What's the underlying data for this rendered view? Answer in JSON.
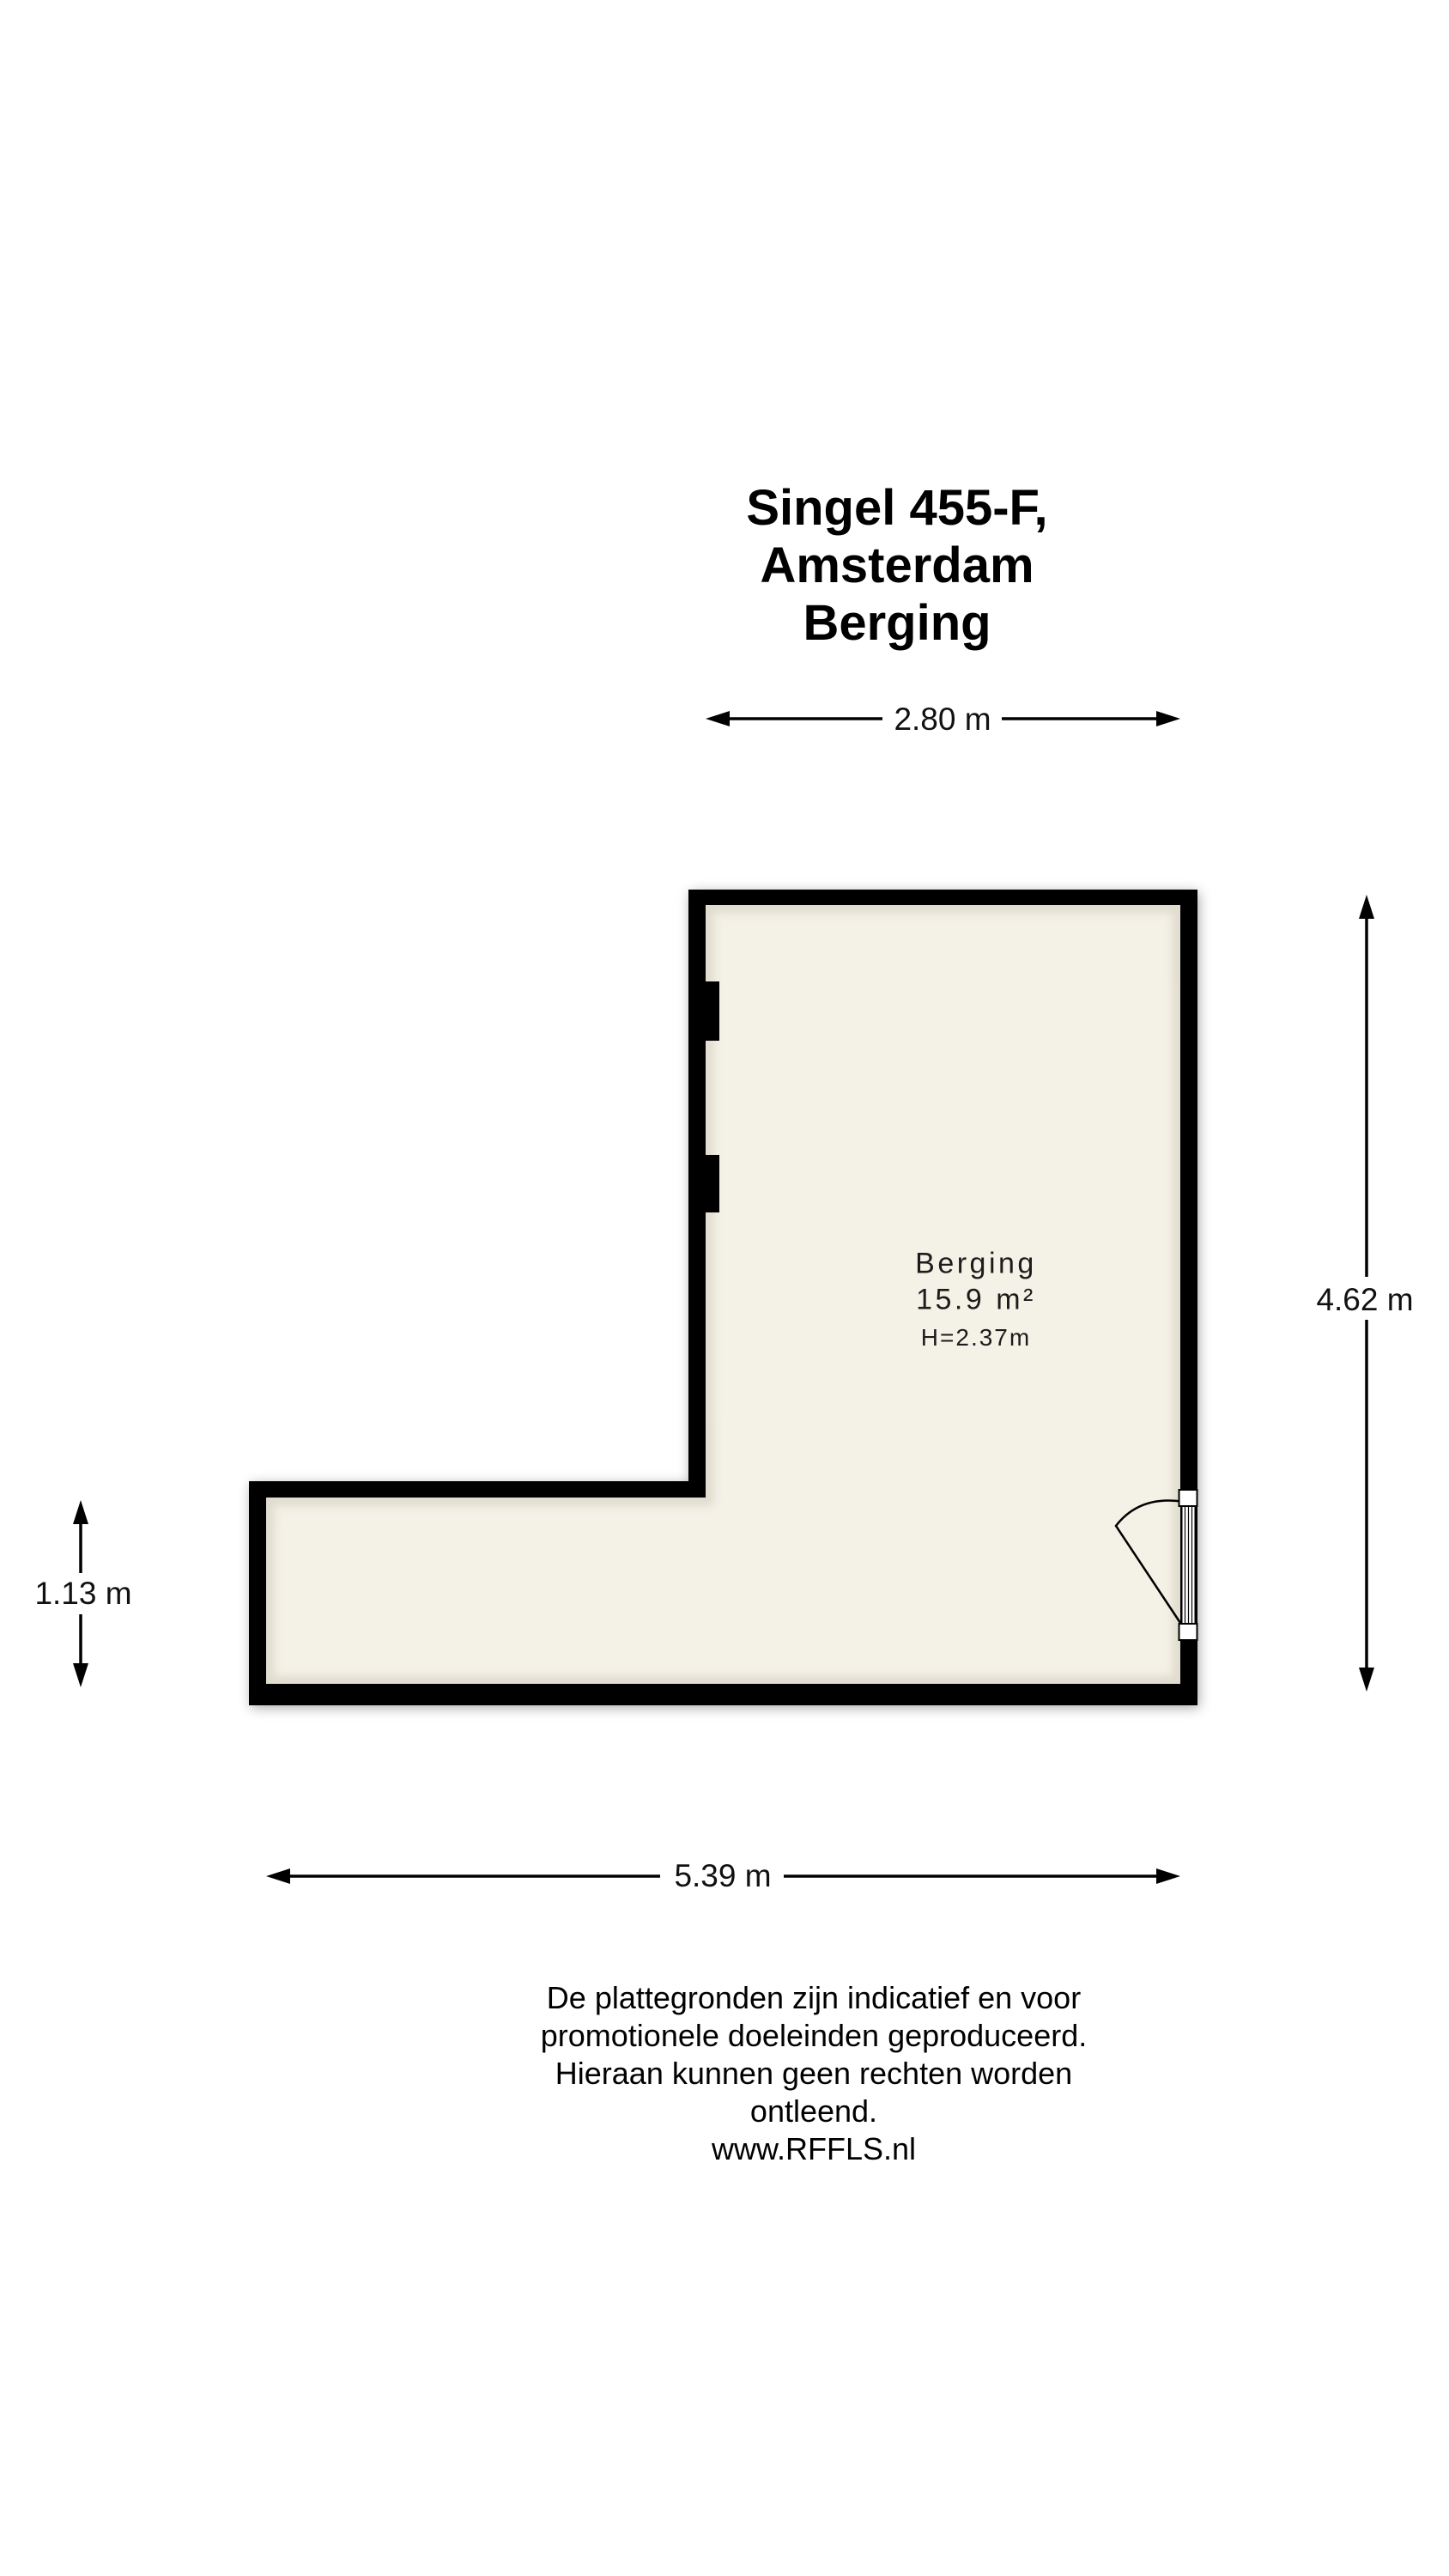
{
  "title": {
    "line1": "Singel 455-F, Amsterdam",
    "line2": "Berging"
  },
  "room": {
    "name": "Berging",
    "area": "15.9 m²",
    "ceiling_height": "H=2.37m"
  },
  "dimensions": {
    "top_width": "2.80 m",
    "right_height": "4.62 m",
    "left_height": "1.13 m",
    "bottom_width": "5.39 m"
  },
  "footer": {
    "line1": "De plattegronden zijn indicatief en voor promotionele doeleinden geproduceerd.",
    "line2": "Hieraan kunnen geen rechten worden ontleend.",
    "line3": "www.RFFLS.nl"
  },
  "colors": {
    "wall": "#000000",
    "floor": "#f4f1e6",
    "floor_edge_shade": "#cfcaba",
    "text": "#1c1c1c",
    "background": "#ffffff"
  }
}
